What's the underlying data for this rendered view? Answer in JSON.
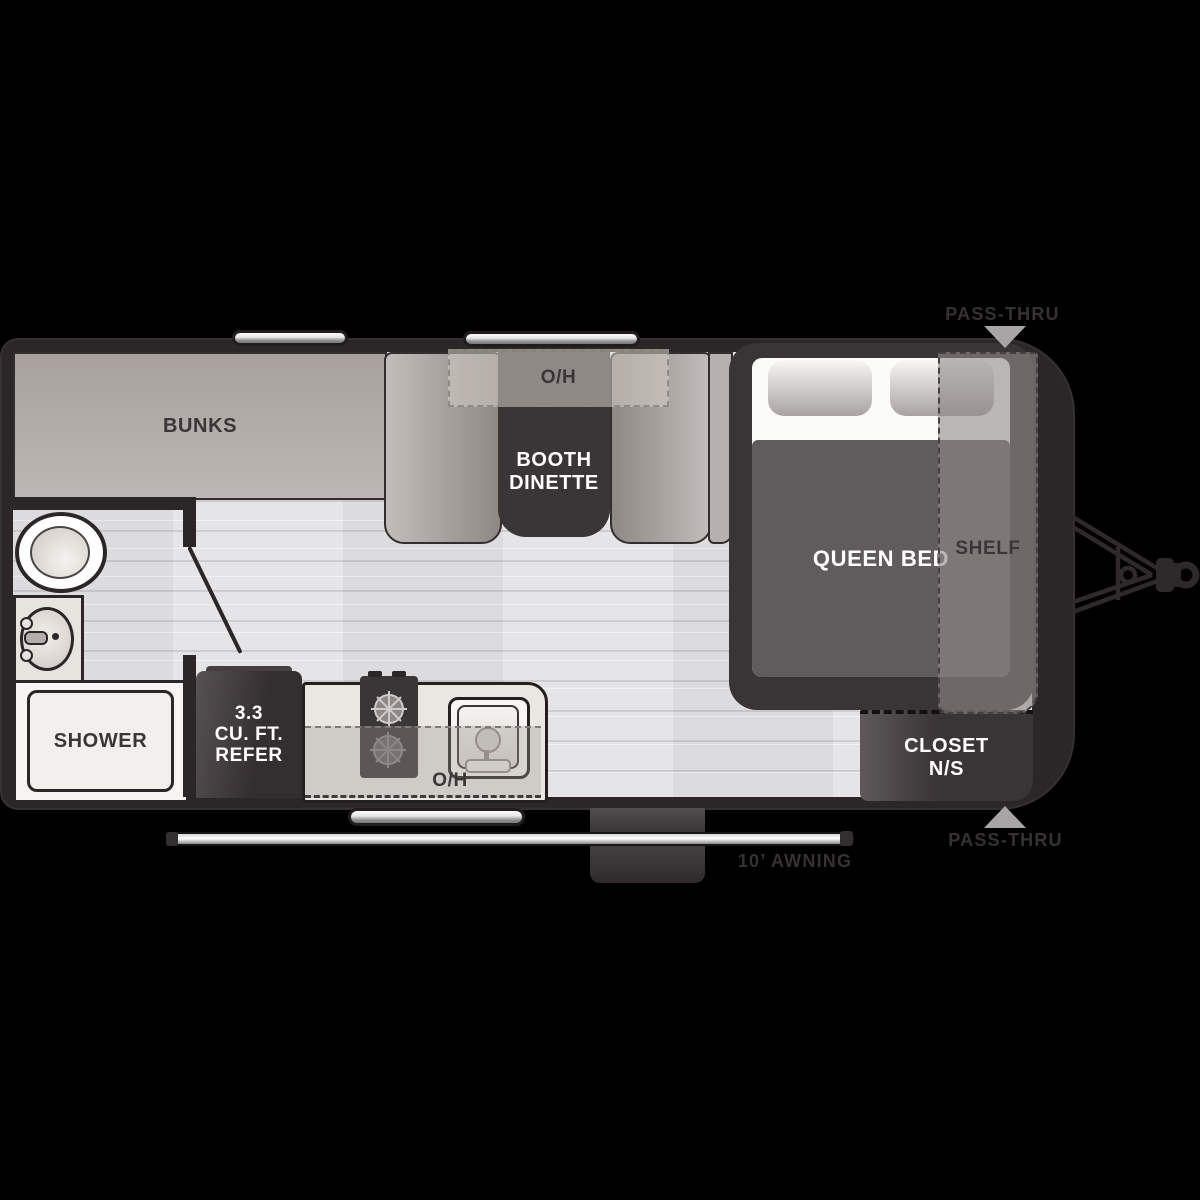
{
  "title": "Travel trailer floor plan",
  "colors": {
    "background": "#000000",
    "trailer_wall": "#2b2728",
    "furniture_dark": "#3a3536",
    "upholstery_gray": "#aaa49f",
    "floor_light": "#e5e5e7",
    "label_dark": "#3a3637",
    "label_white": "#ffffff",
    "exterior_label": "#363233",
    "arrow_gray": "#a7a5a5",
    "window_silver": "#d2d2d2"
  },
  "rooms": {
    "bunks": {
      "label": "BUNKS"
    },
    "dinette": {
      "overhead_label": "O/H",
      "table_label_line1": "BOOTH",
      "table_label_line2": "DINETTE"
    },
    "bedroom": {
      "bed_label": "QUEEN BED",
      "shelf_label": "SHELF",
      "closet_label_line1": "CLOSET",
      "closet_label_line2": "N/S"
    },
    "bathroom": {
      "shower_label": "SHOWER"
    },
    "kitchen": {
      "refer_label_line1": "3.3",
      "refer_label_line2": "CU. FT.",
      "refer_label_line3": "REFER",
      "overhead_label": "O/H"
    }
  },
  "exterior": {
    "pass_thru_top": "PASS-THRU",
    "pass_thru_bottom": "PASS-THRU",
    "awning": "10’ AWNING"
  }
}
